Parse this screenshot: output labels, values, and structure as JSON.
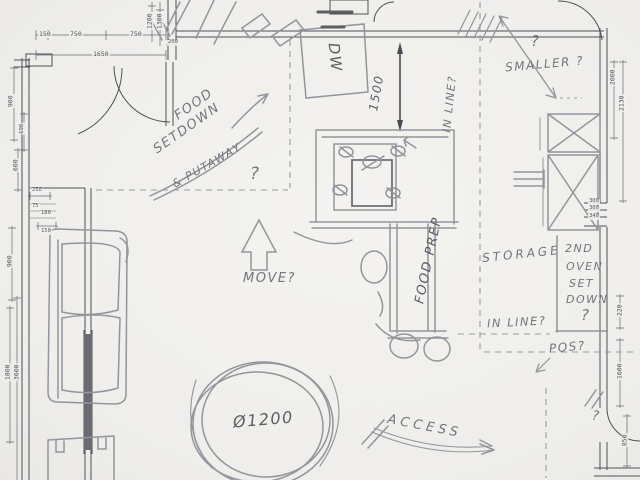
{
  "annotations": {
    "food": "FOOD",
    "setdown": "SETDOWN",
    "putaway": "& PUTAWAY",
    "q_center": "?",
    "dw": "DW",
    "dim_1500": "1500",
    "inline_top": "IN LINE?",
    "q_smaller": "?",
    "smaller": "SMALLER ?",
    "move": "MOVE?",
    "food_prep": "FOOD PREP",
    "storage": "STORAGE",
    "oven_line1": "2ND",
    "oven_line2": "OVEN",
    "oven_line3": "SET",
    "oven_line4": "DOWN",
    "oven_q": "?",
    "inline_bottom": "IN LINE?",
    "pos": "POS?",
    "q_pos": "?",
    "table_dia": "Ø1200",
    "access": "ACCESS"
  },
  "dims": {
    "d150": "150",
    "d750a": "750",
    "d750b": "750",
    "d1650": "1650",
    "d1200": "1200",
    "d1300": "1300",
    "d200": "200",
    "d900a": "900",
    "d690": "690",
    "d600": "600",
    "d250": "250",
    "d75": "75",
    "d180": "180",
    "d150b": "150",
    "d900b": "900",
    "d1800": "1800",
    "d3600": "3600",
    "d2000": "2000",
    "d2130": "2130",
    "d300a": "300",
    "d300b": "300",
    "d340": "340",
    "d220": "220",
    "d1600": "1600",
    "d850": "850"
  }
}
